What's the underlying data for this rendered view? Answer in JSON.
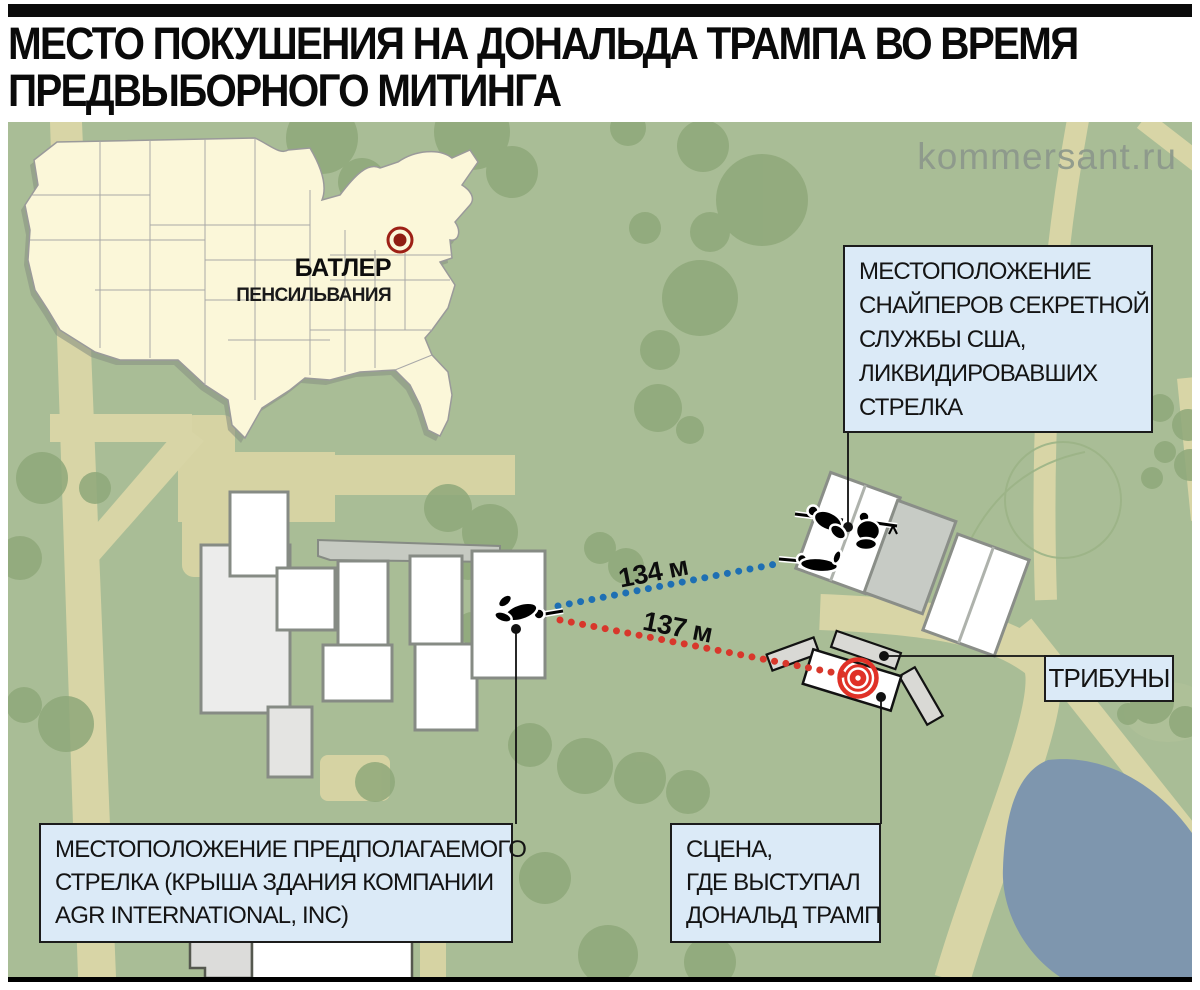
{
  "title": {
    "line1": "МЕСТО ПОКУШЕНИЯ НА ДОНАЛЬДА ТРАМПА ВО ВРЕМЯ",
    "line2": "ПРЕДВЫБОРНОГО МИТИНГА"
  },
  "watermark": "kommersant.ru",
  "inset_map": {
    "city": "БАТЛЕР",
    "region": "ПЕНСИЛЬВАНИЯ"
  },
  "distances": {
    "sniper_line_label": "134 м",
    "shooter_line_label": "137 м"
  },
  "labels": {
    "snipers": {
      "line1": "МЕСТОПОЛОЖЕНИЕ",
      "line2": "СНАЙПЕРОВ СЕКРЕТНОЙ",
      "line3": "СЛУЖБЫ США,",
      "line4": "ЛИКВИДИРОВАВШИХ",
      "line5": "СТРЕЛКА"
    },
    "tribunes": "ТРИБУНЫ",
    "shooter": {
      "line1": "МЕСТОПОЛОЖЕНИЕ ПРЕДПОЛАГАЕМОГО",
      "line2": "СТРЕЛКА (КРЫША ЗДАНИЯ КОМПАНИИ",
      "line3": "AGR INTERNATIONAL, INC)"
    },
    "stage": {
      "line1": "СЦЕНА,",
      "line2": "ГДЕ ВЫСТУПАЛ",
      "line3": "ДОНАЛЬД ТРАМП"
    }
  },
  "icons": {
    "stage_marker": "bullseye-target-icon",
    "city_marker": "bullseye-marker-icon",
    "sniper_figures": "sniper-silhouette-icon",
    "shooter_figure": "shooter-silhouette-icon"
  },
  "colors": {
    "map_background": "#a9bd96",
    "trees": "#8fa87a",
    "roads": "#d8d5a6",
    "pond": "#7e96ae",
    "usa_fill": "#fbf7d9",
    "label_box_bg": "#dbeaf7",
    "sniper_line": "#1e6fb3",
    "shooter_line": "#d8372b",
    "target_red": "#e03127",
    "marker_dark_red": "#9d2016"
  }
}
